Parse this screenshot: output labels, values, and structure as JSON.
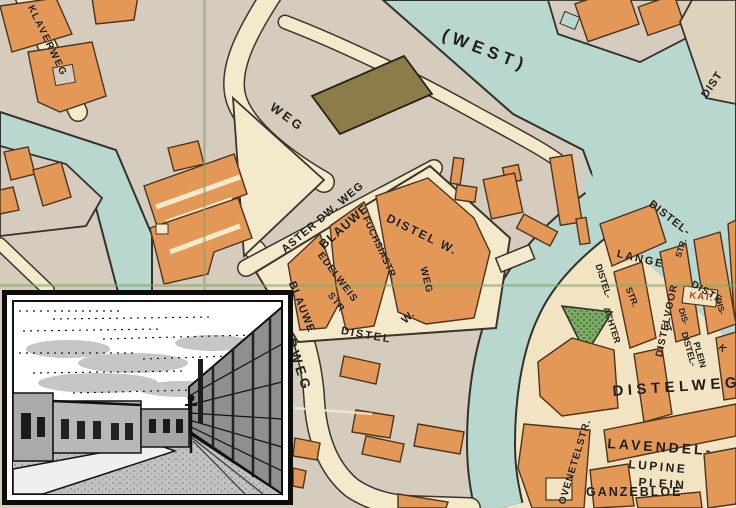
{
  "title": "historic street map with photo inset",
  "labels": {
    "klaverweg": "KLAVERWEG",
    "west": "(WEST)",
    "weg_top": "WEG",
    "dist_corner": "DIST",
    "aster_dw_weg": "ASTER DW. WEG",
    "blauwe_top": "BLAUWE",
    "distel_w": "DISTEL W.",
    "weg_vertical": "WEG",
    "fuchsiastr": "FUCHSIASTR.",
    "edelweis": "EDELWEIS",
    "edelweis_str": "STR.",
    "blauwe_left": "BLAUWE",
    "distel_bottom": "DISTEL",
    "w_bottom": "W.",
    "asterweg": "ASTERWEG",
    "distel_bank": "DISTEL-",
    "lange": "LANGE",
    "distel_achter": "DISTEL-",
    "achter": "ACHTER",
    "achter_str": "STR.",
    "distelvoor": "DISTELVOOR",
    "voor_str": "STR.",
    "distel_edge": "DISTE",
    "kat": "KAT.",
    "dis_1": "DIS-",
    "st_small": "ST",
    "distel_plein": "DISTEL-",
    "plein_vertical": "PLEIN",
    "dis_edge": "DIS-",
    "k_edge": "K",
    "distelweg": "DISTELWEG",
    "ovenetelstr": "OVENETELSTR.",
    "lavendel": "LAVENDEL-",
    "lupine": "LUPINE",
    "plein": "PLEIN",
    "ganzebloe": "GANZEBLOE"
  },
  "colors": {
    "water": "#b7d7cf",
    "land": "#d6ccbd",
    "street": "#f4e9cb",
    "district_background": "#f2e4c3",
    "building": "#e49858",
    "building_outline": "#4a331c",
    "olive_building": "#8c7c49",
    "park_green": "#7cab62",
    "gridline_green": "#86a463",
    "label_ink": "#1f1c17",
    "kat_label_red": "#a8431f",
    "inset_frame": "#0d0d0d"
  }
}
